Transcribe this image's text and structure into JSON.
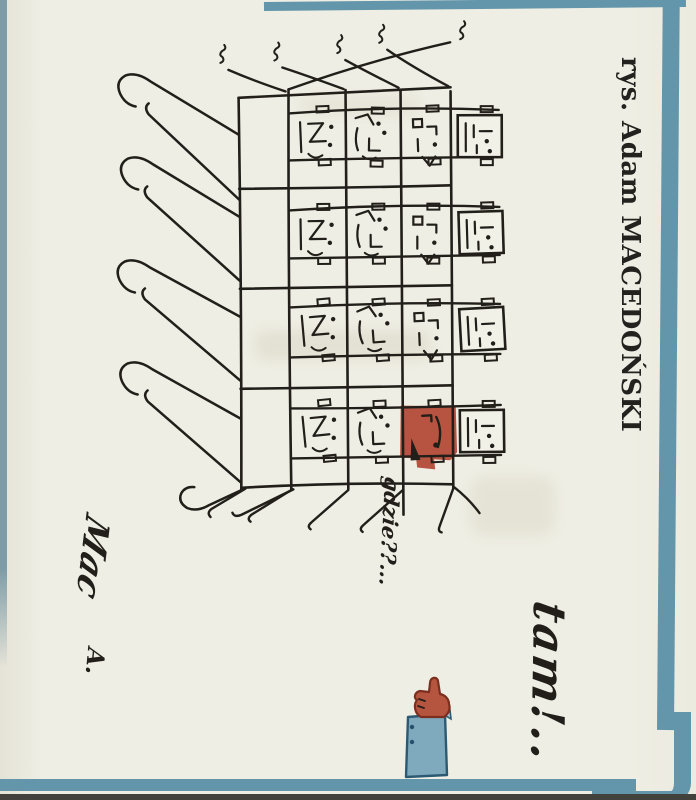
{
  "artwork": {
    "credit": "rys. Adam MACEDOŃSKI",
    "question_text": "gdzie??...",
    "answer_text": "tam!..",
    "signature_line1": "Mac",
    "signature_line2": "A.",
    "building": {
      "floors": 4,
      "windows_per_floor": 4,
      "highlighted_window": {
        "floor_from_top": 4,
        "window_from_left": 3
      }
    },
    "colors": {
      "paper": "#efeee4",
      "ink": "#221f1a",
      "frame_teal": "#6396aa",
      "left_stripe": "#7d9ca7",
      "highlight_red": "#b65341",
      "hand_red": "#b5543f",
      "hand_outline": "#7c2e1f",
      "sleeve_blue": "#7fa9bd",
      "sleeve_outline": "#2c5a72",
      "bottom_edge": "#43413b",
      "ghost_showthrough": "#dcd9c8"
    }
  }
}
